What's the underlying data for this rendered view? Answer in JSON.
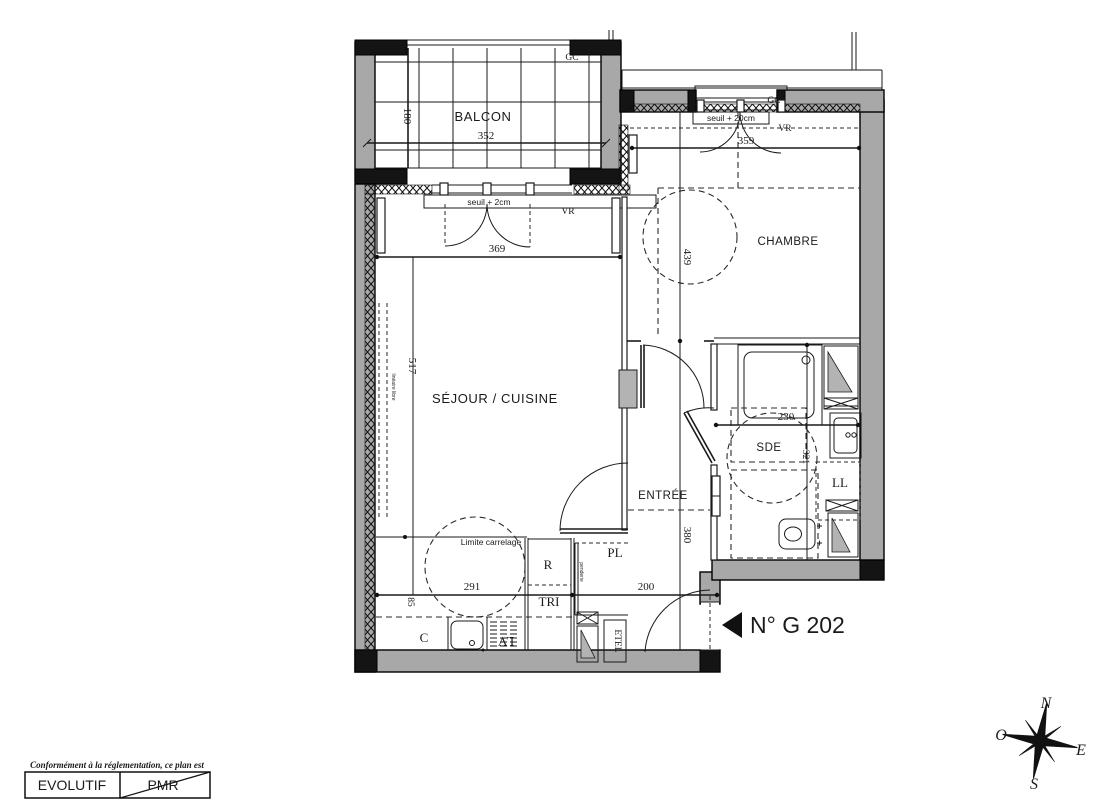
{
  "plan": {
    "unit_number": "N° G 202",
    "rooms": {
      "balcon": "BALCON",
      "chambre": "CHAMBRE",
      "sejour_cuisine": "SÉJOUR / CUISINE",
      "entree": "ENTRÉE",
      "sde": "SDE"
    },
    "equipment": {
      "ll": "LL",
      "pl": "PL",
      "r": "R",
      "tri": "TRI",
      "c": "C",
      "lv": "LV",
      "etel": "ETEL",
      "penderie": "penderie"
    },
    "annotations": {
      "gc": "GC",
      "vr": "VR",
      "seuil_sejour": "seuil + 2cm",
      "seuil_chambre": "seuil + 20cm",
      "limite_carrelage": "Limite carrelage",
      "lineaire_libre": "linéaire libre"
    },
    "dimensions": {
      "balcon_width": "352",
      "balcon_depth": "180",
      "sejour_width": "369",
      "sejour_height": "517",
      "chambre_width": "359",
      "chambre_height": "439",
      "sde_width": "230",
      "sde_height": "321",
      "entree_height": "380",
      "cuisine_width": "291",
      "entree_width": "200",
      "cuisine_depth": "85"
    }
  },
  "compass": {
    "north": "N",
    "south": "S",
    "east": "E",
    "west": "O"
  },
  "footer": {
    "notice": "Conformément à la réglementation, ce plan est",
    "evolutif": "EVOLUTIF",
    "pmr": "PMR"
  },
  "colors": {
    "wall": "#a8a8a8",
    "line": "#1a1a1a",
    "background": "#ffffff"
  }
}
